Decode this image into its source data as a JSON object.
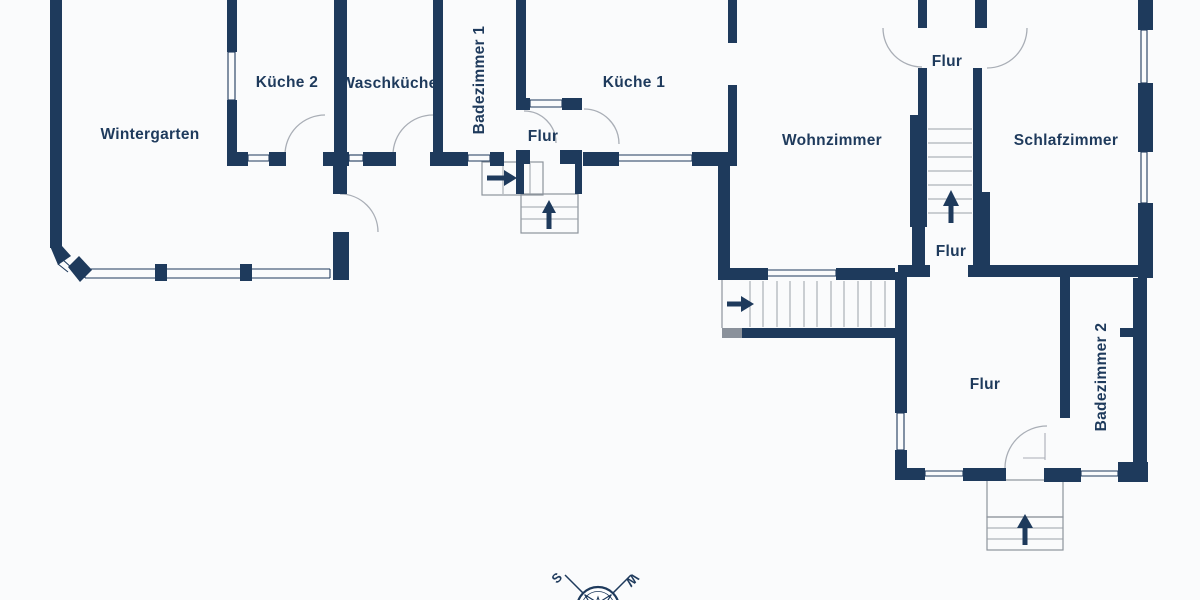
{
  "floorplan": {
    "colors": {
      "background": "#fafbfc",
      "wall": "#1e3a5c",
      "wall_gray": "#8a919b",
      "window_line": "#1e3a5c",
      "door_arc": "#a9aeb6",
      "stair_line": "#9aa0a8",
      "stair_outline": "#8d949d",
      "arrow": "#1e3a5c",
      "label": "#1e3a5c"
    },
    "labels": [
      {
        "id": "wintergarten",
        "text": "Wintergarten",
        "x": 150,
        "y": 134,
        "rot": 0
      },
      {
        "id": "kueche-2",
        "text": "Küche 2",
        "x": 287,
        "y": 82,
        "rot": 0
      },
      {
        "id": "waschkueche",
        "text": "Waschküche",
        "x": 389,
        "y": 83,
        "rot": 0
      },
      {
        "id": "badezimmer-1",
        "text": "Badezimmer 1",
        "x": 479,
        "y": 80,
        "rot": -90
      },
      {
        "id": "flur-klein",
        "text": "Flur",
        "x": 543,
        "y": 136,
        "rot": 0
      },
      {
        "id": "kueche-1",
        "text": "Küche 1",
        "x": 634,
        "y": 82,
        "rot": 0
      },
      {
        "id": "wohnzimmer",
        "text": "Wohnzimmer",
        "x": 832,
        "y": 140,
        "rot": 0
      },
      {
        "id": "flur-oben",
        "text": "Flur",
        "x": 947,
        "y": 61,
        "rot": 0
      },
      {
        "id": "schlafzimmer",
        "text": "Schlafzimmer",
        "x": 1066,
        "y": 140,
        "rot": 0
      },
      {
        "id": "flur-mitte",
        "text": "Flur",
        "x": 951,
        "y": 251,
        "rot": 0
      },
      {
        "id": "flur-unten",
        "text": "Flur",
        "x": 985,
        "y": 384,
        "rot": 0
      },
      {
        "id": "badezimmer-2",
        "text": "Badezimmer 2",
        "x": 1101,
        "y": 377,
        "rot": -90
      }
    ],
    "walls": [
      [
        50,
        0,
        12,
        248
      ],
      [
        227,
        0,
        10,
        52
      ],
      [
        227,
        100,
        10,
        54
      ],
      [
        334,
        0,
        13,
        154
      ],
      [
        333,
        154,
        14,
        40
      ],
      [
        333,
        232,
        16,
        48
      ],
      [
        433,
        0,
        10,
        154
      ],
      [
        516,
        0,
        10,
        110
      ],
      [
        728,
        0,
        9,
        43
      ],
      [
        728,
        85,
        9,
        71
      ],
      [
        718,
        156,
        12,
        112
      ],
      [
        918,
        0,
        9,
        28
      ],
      [
        918,
        68,
        9,
        47
      ],
      [
        910,
        115,
        17,
        112
      ],
      [
        912,
        227,
        13,
        40
      ],
      [
        975,
        0,
        12,
        28
      ],
      [
        973,
        68,
        9,
        47
      ],
      [
        973,
        115,
        9,
        77
      ],
      [
        973,
        192,
        17,
        75
      ],
      [
        1138,
        0,
        15,
        30
      ],
      [
        1138,
        83,
        15,
        69
      ],
      [
        1138,
        203,
        15,
        75
      ],
      [
        1133,
        278,
        14,
        184
      ],
      [
        1120,
        328,
        13,
        9
      ],
      [
        1060,
        275,
        10,
        143
      ],
      [
        895,
        272,
        12,
        141
      ],
      [
        895,
        450,
        12,
        30
      ],
      [
        516,
        150,
        14,
        14
      ],
      [
        516,
        164,
        8,
        30
      ],
      [
        575,
        164,
        7,
        30
      ],
      [
        227,
        152,
        21,
        14
      ],
      [
        269,
        152,
        17,
        14
      ],
      [
        323,
        152,
        26,
        14
      ],
      [
        363,
        152,
        33,
        14
      ],
      [
        430,
        152,
        38,
        14
      ],
      [
        490,
        152,
        14,
        14
      ],
      [
        560,
        150,
        22,
        14
      ],
      [
        583,
        152,
        36,
        14
      ],
      [
        692,
        152,
        45,
        14
      ],
      [
        516,
        98,
        14,
        12
      ],
      [
        562,
        98,
        20,
        12
      ],
      [
        718,
        268,
        50,
        12
      ],
      [
        836,
        268,
        59,
        12
      ],
      [
        742,
        328,
        153,
        10
      ],
      [
        898,
        265,
        32,
        12
      ],
      [
        968,
        265,
        175,
        12
      ],
      [
        895,
        468,
        30,
        12
      ],
      [
        963,
        468,
        43,
        13
      ],
      [
        1044,
        468,
        37,
        14
      ],
      [
        1118,
        462,
        30,
        20
      ],
      [
        155,
        264,
        12,
        17
      ],
      [
        240,
        264,
        12,
        17
      ]
    ],
    "gray_walls": [
      [
        722,
        328,
        20,
        10
      ]
    ],
    "wall_polys": [
      [
        [
          50,
          246
        ],
        [
          62,
          246
        ],
        [
          71,
          256
        ],
        [
          58,
          265
        ]
      ],
      [
        [
          68,
          267
        ],
        [
          79,
          256
        ],
        [
          92,
          270
        ],
        [
          80,
          282
        ]
      ]
    ],
    "diag_window_lines": [
      [
        58,
        264,
        68,
        272
      ],
      [
        62,
        259,
        72,
        268
      ]
    ],
    "windows": [
      {
        "o": "h",
        "x": 248,
        "y": 155,
        "l": 21,
        "g": 6
      },
      {
        "o": "h",
        "x": 349,
        "y": 155,
        "l": 14,
        "g": 6
      },
      {
        "o": "h",
        "x": 468,
        "y": 155,
        "l": 22,
        "g": 6
      },
      {
        "o": "h",
        "x": 530,
        "y": 100,
        "l": 32,
        "g": 7
      },
      {
        "o": "h",
        "x": 618,
        "y": 155,
        "l": 74,
        "g": 6
      },
      {
        "o": "h",
        "x": 85,
        "y": 269,
        "l": 245,
        "g": 9
      },
      {
        "o": "h",
        "x": 767,
        "y": 270,
        "l": 69,
        "g": 6
      },
      {
        "o": "h",
        "x": 925,
        "y": 471,
        "l": 38,
        "g": 5
      },
      {
        "o": "h",
        "x": 1081,
        "y": 471,
        "l": 37,
        "g": 5
      },
      {
        "o": "v",
        "x": 228,
        "y": 52,
        "l": 48,
        "g": 7
      },
      {
        "o": "v",
        "x": 1141,
        "y": 30,
        "l": 53,
        "g": 6
      },
      {
        "o": "v",
        "x": 1141,
        "y": 152,
        "l": 51,
        "g": 6
      },
      {
        "o": "v",
        "x": 897,
        "y": 413,
        "l": 37,
        "g": 7
      }
    ],
    "doors": [
      "M285,155 A40,40 0 0 1 325,115",
      "M393,155 A40,40 0 0 1 433,115",
      "M340,194 A38,38 0 0 1 378,232",
      "M524,111 A32,32 0 0 1 556,143",
      "M584,109 A35,35 0 0 1 619,144",
      "M883,28 A39,39 0 0 0 922,67",
      "M987,68 A40,40 0 0 0 1027,28",
      "M1005,468 A42,42 0 0 1 1047,426"
    ],
    "door_lines": [
      [
        1045,
        433,
        1045,
        460
      ],
      [
        1023,
        458,
        1045,
        458
      ]
    ],
    "stairs": {
      "outline_rects": [
        [
          521,
          194,
          57,
          39
        ],
        [
          482,
          162,
          61,
          33
        ],
        [
          987,
          480,
          76,
          37
        ],
        [
          987,
          517,
          76,
          33
        ]
      ],
      "outline_lines": [
        [
          722,
          280,
          722,
          328
        ]
      ],
      "tread_lines": [
        [
          928,
          129,
          972,
          129
        ],
        [
          928,
          143,
          972,
          143
        ],
        [
          928,
          157,
          972,
          157
        ],
        [
          928,
          171,
          972,
          171
        ],
        [
          928,
          185,
          972,
          185
        ],
        [
          928,
          199,
          972,
          199
        ],
        [
          928,
          213,
          972,
          213
        ],
        [
          750,
          281,
          750,
          327
        ],
        [
          763,
          281,
          763,
          327
        ],
        [
          777,
          281,
          777,
          327
        ],
        [
          790,
          281,
          790,
          327
        ],
        [
          804,
          281,
          804,
          327
        ],
        [
          817,
          281,
          817,
          327
        ],
        [
          831,
          281,
          831,
          327
        ],
        [
          844,
          281,
          844,
          327
        ],
        [
          858,
          281,
          858,
          327
        ],
        [
          871,
          281,
          871,
          327
        ],
        [
          885,
          281,
          885,
          327
        ],
        [
          521,
          207,
          578,
          207
        ],
        [
          521,
          219,
          578,
          219
        ],
        [
          503,
          163,
          503,
          194
        ],
        [
          517,
          163,
          517,
          194
        ],
        [
          530,
          163,
          530,
          194
        ],
        [
          987,
          528,
          1063,
          528
        ],
        [
          987,
          539,
          1063,
          539
        ]
      ],
      "arrows": [
        {
          "shaft": [
            951,
            223,
            951,
            206
          ],
          "head": [
            [
              943,
              206
            ],
            [
              959,
              206
            ],
            [
              951,
              190
            ]
          ]
        },
        {
          "shaft": [
            727,
            304,
            741,
            304
          ],
          "head": [
            [
              741,
              296
            ],
            [
              741,
              312
            ],
            [
              754,
              304
            ]
          ]
        },
        {
          "shaft": [
            549,
            229,
            549,
            213
          ],
          "head": [
            [
              542,
              213
            ],
            [
              556,
              213
            ],
            [
              549,
              200
            ]
          ]
        },
        {
          "shaft": [
            487,
            178,
            504,
            178
          ],
          "head": [
            [
              504,
              170
            ],
            [
              504,
              186
            ],
            [
              517,
              178
            ]
          ]
        },
        {
          "shaft": [
            1025,
            545,
            1025,
            528
          ],
          "head": [
            [
              1017,
              528
            ],
            [
              1033,
              528
            ],
            [
              1025,
              514
            ]
          ]
        }
      ]
    },
    "compass": {
      "cx": 598,
      "cy": 608,
      "r_outer": 21,
      "r_inner": 16.5,
      "spokes": [
        [
          598,
          608,
          565,
          575
        ],
        [
          598,
          608,
          631,
          575
        ]
      ],
      "letters": [
        {
          "id": "s",
          "text": "S",
          "x": 560,
          "y": 581,
          "rot": -45
        },
        {
          "id": "w",
          "text": "W",
          "x": 629,
          "y": 577,
          "rot": 135
        }
      ]
    }
  }
}
